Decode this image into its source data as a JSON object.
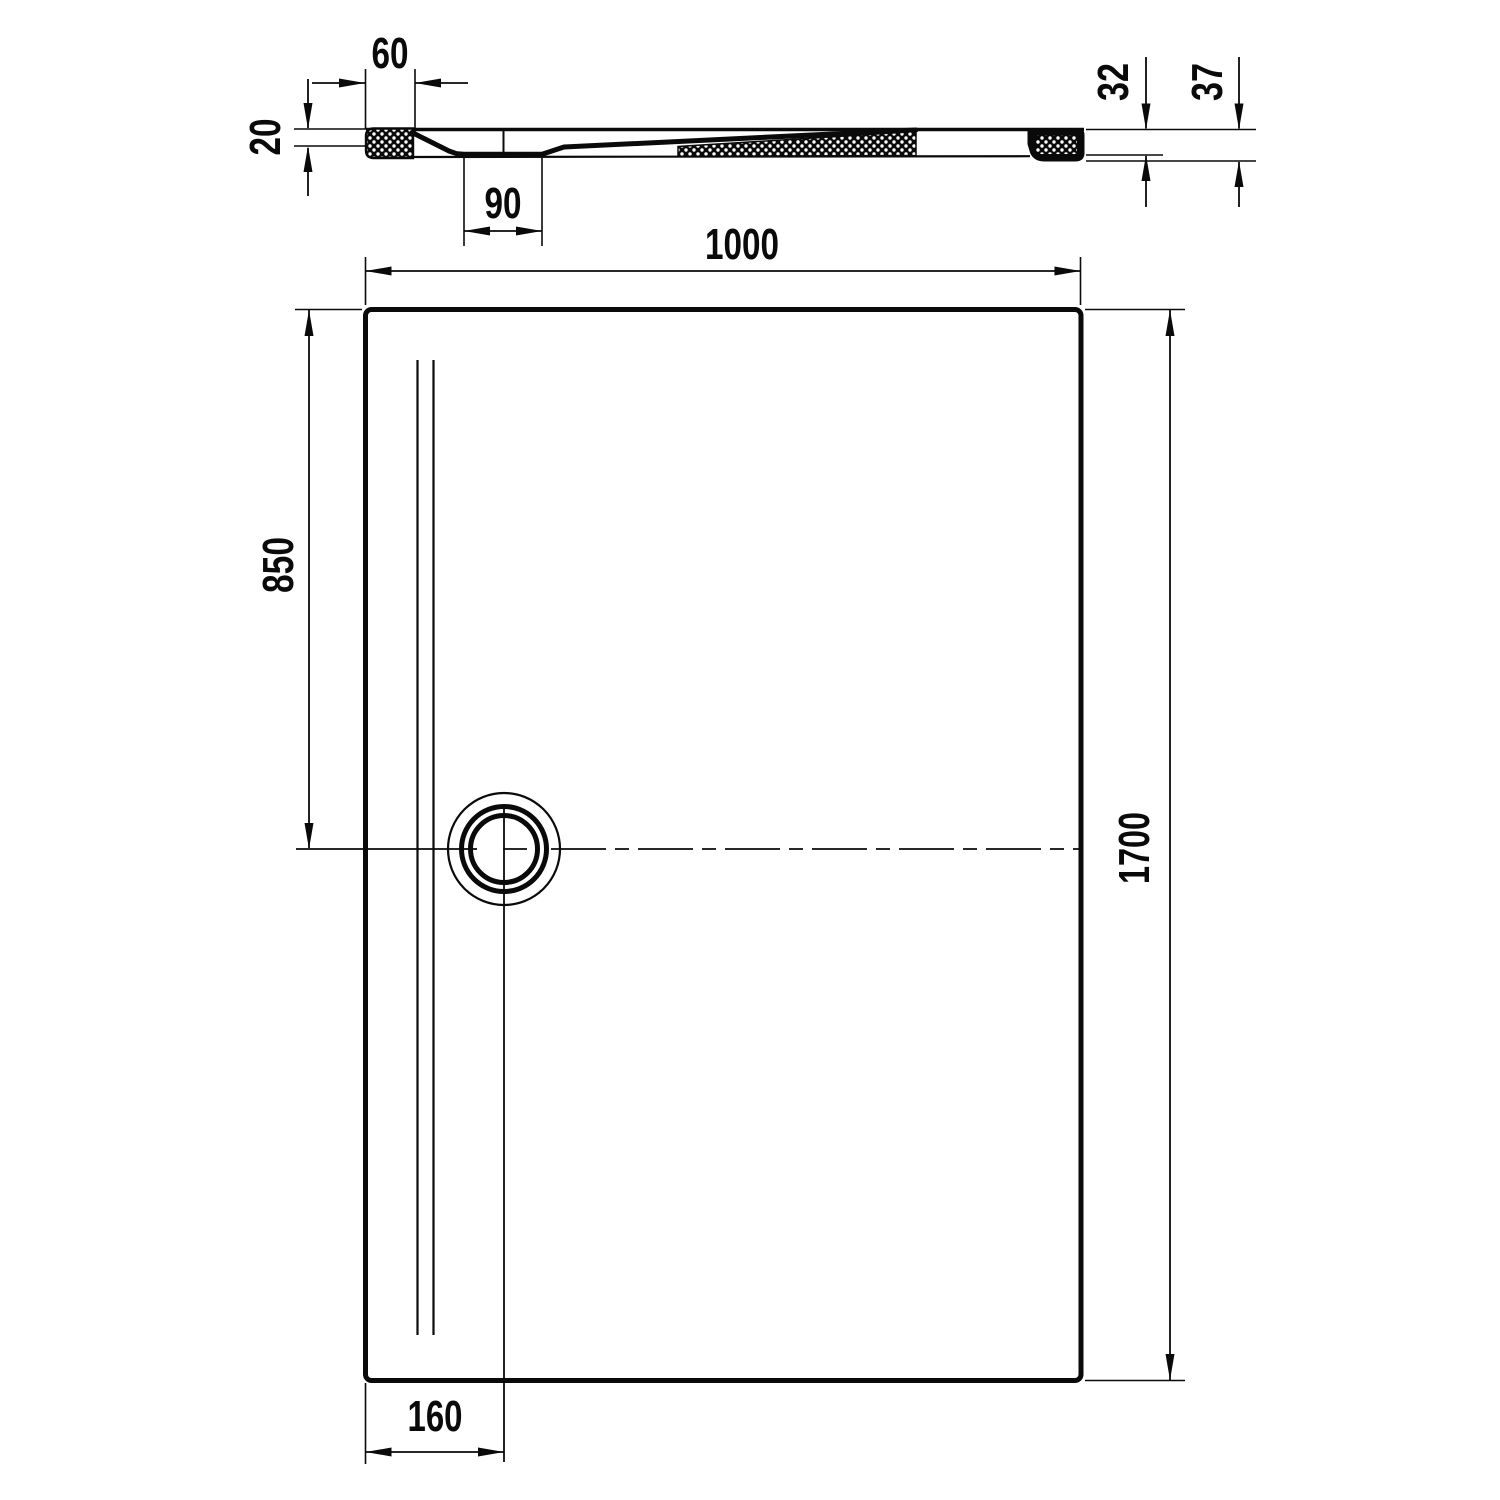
{
  "drawing": {
    "kind": "shower-tray technical drawing",
    "views": {
      "section": "cross-section profile (top of sheet)",
      "plan": "plan view rectangle with drain (bottom of sheet)"
    }
  },
  "colors": {
    "line": "#0a0a0a",
    "background": "#ffffff"
  },
  "dimensions": {
    "rim_width": {
      "value": "60"
    },
    "edge_thickness": {
      "value": "20"
    },
    "drain_recess_width": {
      "value": "90"
    },
    "overall_width": {
      "value": "1000"
    },
    "drain_center_from_top": {
      "value": "850"
    },
    "overall_length": {
      "value": "1700"
    },
    "drain_center_from_left": {
      "value": "160"
    },
    "right_edge_height": {
      "value": "32"
    },
    "overall_height": {
      "value": "37"
    }
  }
}
